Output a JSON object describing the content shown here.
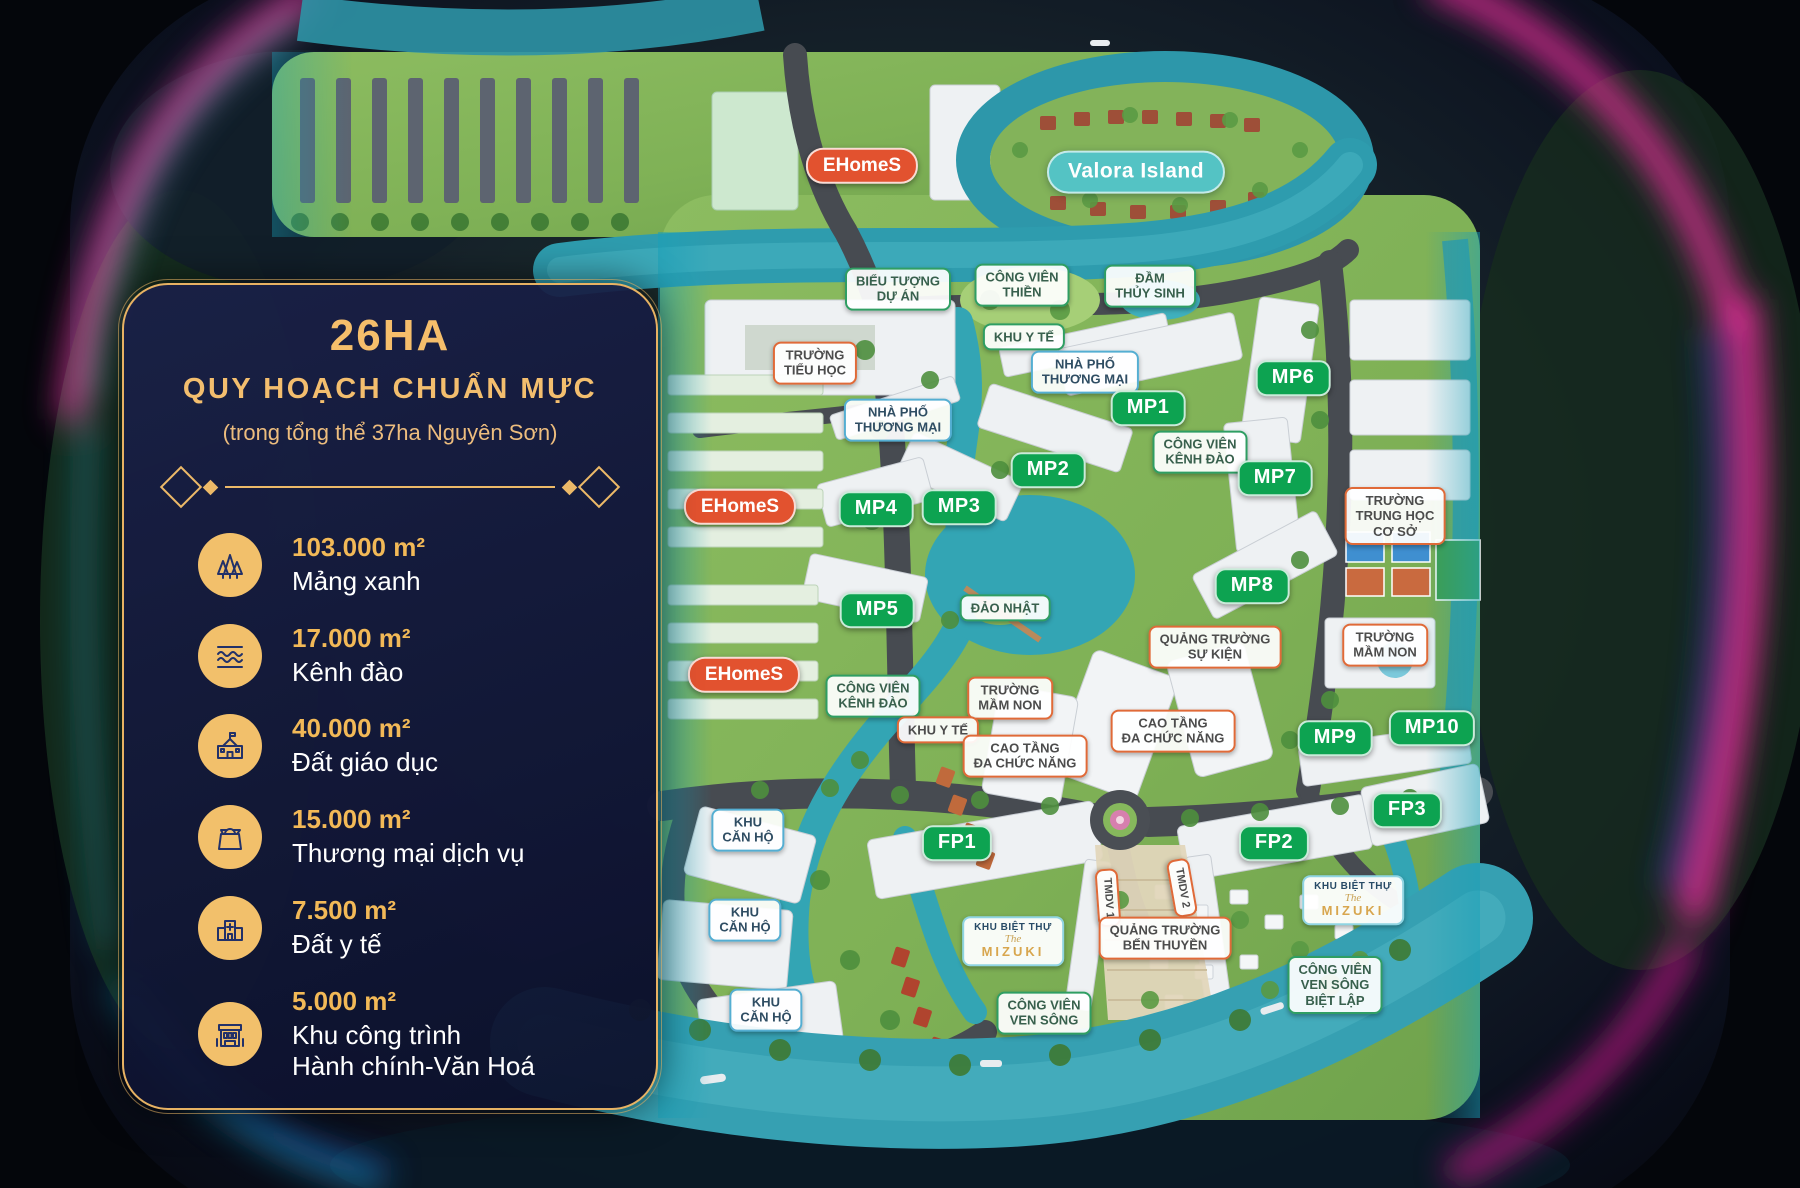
{
  "panel": {
    "title": "26HA",
    "subtitle": "QUY HOẠCH CHUẨN MỰC",
    "note": "(trong tổng thể 37ha Nguyên Sơn)",
    "items": [
      {
        "icon": "trees-icon",
        "value": "103.000 m²",
        "label": "Mảng xanh"
      },
      {
        "icon": "waves-icon",
        "value": "17.000 m²",
        "label": "Kênh đào"
      },
      {
        "icon": "school-icon",
        "value": "40.000 m²",
        "label": "Đất giáo dục"
      },
      {
        "icon": "shopping-bag-icon",
        "value": "15.000 m²",
        "label": "Thương mại dịch vụ"
      },
      {
        "icon": "hospital-icon",
        "value": "7.500 m²",
        "label": "Đất y tế"
      },
      {
        "icon": "civic-building-icon",
        "value": "5.000 m²",
        "label": "Khu công trình\nHành chính-Văn Hoá"
      }
    ]
  },
  "map": {
    "labels": [
      {
        "text": "EHomeS",
        "x": 862,
        "y": 166,
        "style": "red-pill"
      },
      {
        "text": "Valora Island",
        "x": 1136,
        "y": 172,
        "style": "teal-pill"
      },
      {
        "text": "BIỂU TƯỢNG\nDỰ ÁN",
        "x": 898,
        "y": 289,
        "style": "green-outline"
      },
      {
        "text": "CÔNG VIÊN\nTHIỀN",
        "x": 1022,
        "y": 285,
        "style": "green-outline"
      },
      {
        "text": "ĐẦM\nTHỦY SINH",
        "x": 1150,
        "y": 286,
        "style": "green-outline"
      },
      {
        "text": "KHU Y TẾ",
        "x": 1024,
        "y": 337,
        "style": "green-outline"
      },
      {
        "text": "TRƯỜNG\nTIỂU HỌC",
        "x": 815,
        "y": 363,
        "style": "orange-outline"
      },
      {
        "text": "NHÀ PHỐ\nTHƯƠNG MẠI",
        "x": 1085,
        "y": 372,
        "style": "blue-outline"
      },
      {
        "text": "MP6",
        "x": 1293,
        "y": 378,
        "style": "green-pill"
      },
      {
        "text": "MP1",
        "x": 1148,
        "y": 408,
        "style": "green-pill"
      },
      {
        "text": "NHÀ PHỐ\nTHƯƠNG MẠI",
        "x": 898,
        "y": 420,
        "style": "blue-outline"
      },
      {
        "text": "CÔNG VIÊN\nKÊNH ĐÀO",
        "x": 1200,
        "y": 452,
        "style": "green-outline"
      },
      {
        "text": "MP2",
        "x": 1048,
        "y": 470,
        "style": "green-pill"
      },
      {
        "text": "MP7",
        "x": 1275,
        "y": 478,
        "style": "green-pill"
      },
      {
        "text": "EHomeS",
        "x": 740,
        "y": 507,
        "style": "red-pill"
      },
      {
        "text": "MP4",
        "x": 876,
        "y": 509,
        "style": "green-pill"
      },
      {
        "text": "MP3",
        "x": 959,
        "y": 507,
        "style": "green-pill"
      },
      {
        "text": "TRƯỜNG\nTRUNG HỌC\nCƠ SỞ",
        "x": 1395,
        "y": 516,
        "style": "orange-outline"
      },
      {
        "text": "MP8",
        "x": 1252,
        "y": 586,
        "style": "green-pill"
      },
      {
        "text": "ĐẢO NHẬT",
        "x": 1005,
        "y": 608,
        "style": "green-outline"
      },
      {
        "text": "MP5",
        "x": 877,
        "y": 610,
        "style": "green-pill"
      },
      {
        "text": "QUẢNG TRƯỜNG\nSỰ KIỆN",
        "x": 1215,
        "y": 647,
        "style": "orange-outline"
      },
      {
        "text": "TRƯỜNG\nMẦM NON",
        "x": 1385,
        "y": 645,
        "style": "orange-outline"
      },
      {
        "text": "EHomeS",
        "x": 744,
        "y": 675,
        "style": "red-pill"
      },
      {
        "text": "CÔNG VIÊN\nKÊNH ĐÀO",
        "x": 873,
        "y": 696,
        "style": "green-outline"
      },
      {
        "text": "TRƯỜNG\nMẦM NON",
        "x": 1010,
        "y": 698,
        "style": "orange-outline"
      },
      {
        "text": "KHU Y TẾ",
        "x": 938,
        "y": 730,
        "style": "orange-outline"
      },
      {
        "text": "CAO TẦNG\nĐA CHỨC NĂNG",
        "x": 1173,
        "y": 731,
        "style": "orange-outline"
      },
      {
        "text": "MP9",
        "x": 1335,
        "y": 738,
        "style": "green-pill"
      },
      {
        "text": "MP10",
        "x": 1432,
        "y": 728,
        "style": "green-pill"
      },
      {
        "text": "CAO TẦNG\nĐA CHỨC NĂNG",
        "x": 1025,
        "y": 756,
        "style": "orange-outline"
      },
      {
        "text": "FP3",
        "x": 1407,
        "y": 810,
        "style": "green-pill"
      },
      {
        "text": "KHU\nCĂN HỘ",
        "x": 748,
        "y": 830,
        "style": "blue-outline"
      },
      {
        "text": "FP1",
        "x": 957,
        "y": 843,
        "style": "green-pill"
      },
      {
        "text": "FP2",
        "x": 1274,
        "y": 843,
        "style": "green-pill"
      },
      {
        "text": "TMDV 1",
        "x": 1108,
        "y": 898,
        "style": "vertical-orange",
        "rotate": 86
      },
      {
        "text": "TMDV 2",
        "x": 1182,
        "y": 888,
        "style": "vertical-orange",
        "rotate": 80
      },
      {
        "text": "mizuki",
        "lines": [
          "KHU BIỆT THỰ",
          "The",
          "MIZUKI"
        ],
        "x": 1353,
        "y": 900,
        "style": "mizuki"
      },
      {
        "text": "KHU\nCĂN HỘ",
        "x": 745,
        "y": 920,
        "style": "blue-outline"
      },
      {
        "text": "QUẢNG TRƯỜNG\nBẾN THUYỀN",
        "x": 1165,
        "y": 938,
        "style": "orange-outline"
      },
      {
        "text": "mizuki",
        "lines": [
          "KHU BIỆT THỰ",
          "The",
          "MIZUKI"
        ],
        "x": 1013,
        "y": 941,
        "style": "mizuki"
      },
      {
        "text": "CÔNG VIÊN\nVEN SÔNG\nBIỆT LẬP",
        "x": 1335,
        "y": 985,
        "style": "green-outline"
      },
      {
        "text": "KHU\nCĂN HỘ",
        "x": 766,
        "y": 1010,
        "style": "blue-outline"
      },
      {
        "text": "CÔNG VIÊN\nVEN SÔNG",
        "x": 1044,
        "y": 1013,
        "style": "green-outline"
      }
    ]
  },
  "colors": {
    "gold": "#ecb968",
    "zone_green": "#0da351",
    "zone_red": "#e2522f",
    "water": "#33a5b4",
    "panel_navy": "#141b3d",
    "neon_pink": "#ff38b3",
    "neon_blue": "#2a3bdc",
    "neon_cyan": "#1fb6de"
  }
}
